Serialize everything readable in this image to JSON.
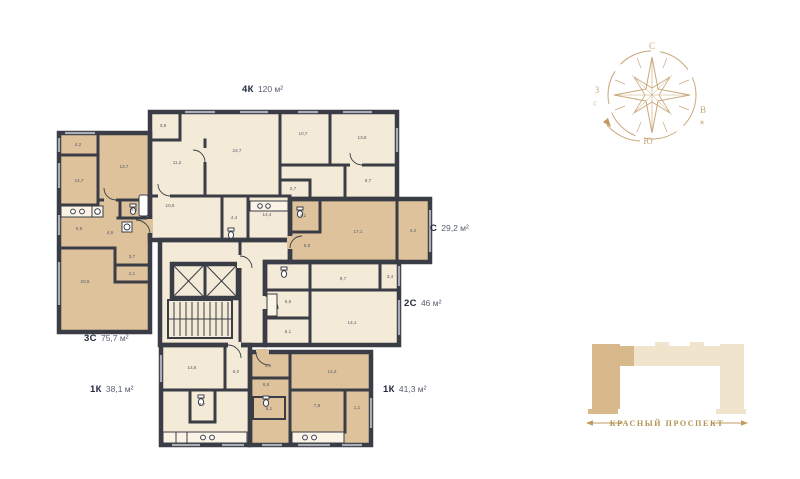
{
  "colors": {
    "wall": "#3a3d45",
    "room_light": "#f4ead8",
    "room_dark": "#ddc29b",
    "window": "#a9adb5",
    "gold": "#c9a87a",
    "street_text": "#b2904f",
    "site_light": "#f1e4cd",
    "site_highlight": "#d8b98c",
    "label_dark": "#232a3e",
    "label_muted": "#5a6070",
    "room_text": "#565b69",
    "background": "#ffffff"
  },
  "floor_plan": {
    "apartments": [
      {
        "id": "4k",
        "type": "4К",
        "area": "120 м²",
        "label": {
          "x": 242,
          "y": 92
        },
        "rooms": [
          {
            "v": "3,8",
            "x": 163,
            "y": 127
          },
          {
            "v": "11,2",
            "x": 177,
            "y": 164
          },
          {
            "v": "24,7",
            "x": 237,
            "y": 152
          },
          {
            "v": "10,7",
            "x": 303,
            "y": 135
          },
          {
            "v": "13,8",
            "x": 362,
            "y": 139
          },
          {
            "v": "9,7",
            "x": 368,
            "y": 182
          },
          {
            "v": "2,7",
            "x": 293,
            "y": 190
          },
          {
            "v": "10,6",
            "x": 170,
            "y": 207
          },
          {
            "v": "4,4",
            "x": 234,
            "y": 219
          },
          {
            "v": "14,4",
            "x": 267,
            "y": 216
          }
        ]
      },
      {
        "id": "3c",
        "type": "3С",
        "area": "75,7 м²",
        "label": {
          "x": 84,
          "y": 341
        },
        "rooms": [
          {
            "v": "4,2",
            "x": 78,
            "y": 146
          },
          {
            "v": "14,7",
            "x": 79,
            "y": 182
          },
          {
            "v": "13,7",
            "x": 124,
            "y": 168
          },
          {
            "v": "4,3",
            "x": 134,
            "y": 211
          },
          {
            "v": "4,6",
            "x": 110,
            "y": 234
          },
          {
            "v": "5,9",
            "x": 79,
            "y": 230
          },
          {
            "v": "3,7",
            "x": 132,
            "y": 258
          },
          {
            "v": "2,1",
            "x": 132,
            "y": 275
          },
          {
            "v": "20,6",
            "x": 85,
            "y": 283
          }
        ]
      },
      {
        "id": "c",
        "type": "С",
        "area": "29,2 м²",
        "label": {
          "x": 430,
          "y": 231
        },
        "rooms": [
          {
            "v": "4,1",
            "x": 303,
            "y": 217
          },
          {
            "v": "5,6",
            "x": 307,
            "y": 247
          },
          {
            "v": "17,1",
            "x": 358,
            "y": 233
          },
          {
            "v": "4,2",
            "x": 413,
            "y": 232
          }
        ]
      },
      {
        "id": "2c",
        "type": "2С",
        "area": "46 м²",
        "label": {
          "x": 404,
          "y": 306
        },
        "rooms": [
          {
            "v": "5,6",
            "x": 288,
            "y": 303
          },
          {
            "v": "9,7",
            "x": 343,
            "y": 280
          },
          {
            "v": "3,4",
            "x": 390,
            "y": 278
          },
          {
            "v": "5,1",
            "x": 288,
            "y": 333
          },
          {
            "v": "14,1",
            "x": 352,
            "y": 324
          }
        ]
      },
      {
        "id": "1k-left",
        "type": "1К",
        "area": "38,1 м²",
        "label": {
          "x": 90,
          "y": 392
        },
        "rooms": [
          {
            "v": "14,6",
            "x": 192,
            "y": 369
          },
          {
            "v": "6,0",
            "x": 236,
            "y": 373
          },
          {
            "v": "3,7",
            "x": 202,
            "y": 406
          }
        ]
      },
      {
        "id": "1k-right",
        "type": "1К",
        "area": "41,3 м²",
        "label": {
          "x": 383,
          "y": 392
        },
        "rooms": [
          {
            "v": "3,8",
            "x": 268,
            "y": 367
          },
          {
            "v": "6,8",
            "x": 266,
            "y": 386
          },
          {
            "v": "14,3",
            "x": 332,
            "y": 373
          },
          {
            "v": "6,1",
            "x": 269,
            "y": 410
          },
          {
            "v": "7,8",
            "x": 317,
            "y": 407
          },
          {
            "v": "1,1",
            "x": 357,
            "y": 409
          }
        ]
      }
    ]
  },
  "compass": {
    "north": "С",
    "east": "В",
    "south": "Ю",
    "west": "З"
  },
  "icons": {
    "moon": "☾",
    "sun": "☀"
  },
  "site_plan": {
    "street": "КРАСНЫЙ ПРОСПЕКТ"
  }
}
